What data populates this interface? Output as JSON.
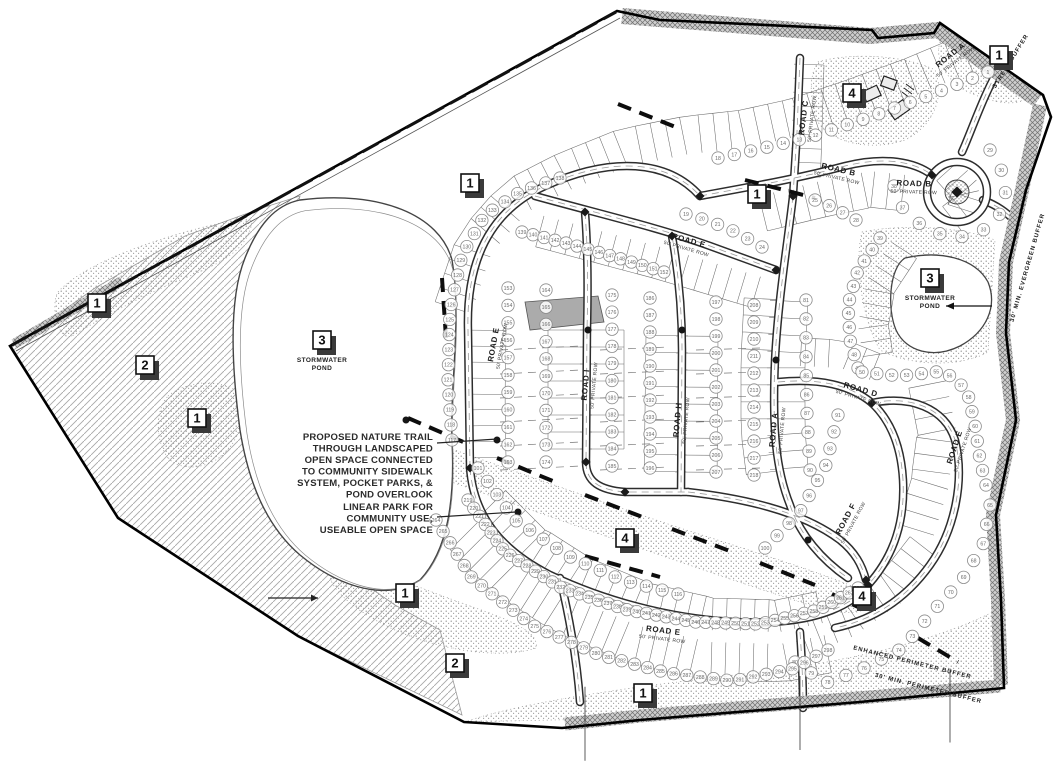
{
  "drawing": {
    "kind": "residential subdivision concept site plan",
    "colors": {
      "paper": "#ffffff",
      "ink": "#1a1a1a",
      "fabric": "#6a6a6a",
      "buffer_fill": "#c9c9c9"
    }
  },
  "callouts": [
    {
      "id": "c1",
      "label": "1",
      "x": 97,
      "y": 303
    },
    {
      "id": "c2",
      "label": "2",
      "x": 145,
      "y": 365
    },
    {
      "id": "c3",
      "label": "1",
      "x": 197,
      "y": 418
    },
    {
      "id": "c4",
      "label": "3",
      "x": 322,
      "y": 340,
      "caption_lines": [
        "STORMWATER",
        "POND"
      ]
    },
    {
      "id": "c5",
      "label": "1",
      "x": 470,
      "y": 183
    },
    {
      "id": "c6",
      "label": "1",
      "x": 757,
      "y": 194
    },
    {
      "id": "c7",
      "label": "4",
      "x": 852,
      "y": 93
    },
    {
      "id": "c8",
      "label": "1",
      "x": 999,
      "y": 55
    },
    {
      "id": "c9",
      "label": "3",
      "x": 930,
      "y": 278,
      "caption_lines": [
        "STORMWATER",
        "POND"
      ],
      "arrow": true
    },
    {
      "id": "c10",
      "label": "4",
      "x": 625,
      "y": 538
    },
    {
      "id": "c11",
      "label": "1",
      "x": 405,
      "y": 593
    },
    {
      "id": "c12",
      "label": "2",
      "x": 455,
      "y": 663
    },
    {
      "id": "c13",
      "label": "1",
      "x": 643,
      "y": 693
    },
    {
      "id": "c14",
      "label": "4",
      "x": 862,
      "y": 596
    }
  ],
  "notes": [
    {
      "id": "nature-trail",
      "lines": [
        "PROPOSED NATURE TRAIL",
        "THROUGH LANDSCAPED",
        "OPEN SPACE CONNECTED",
        "TO COMMUNITY SIDEWALK",
        "SYSTEM, POCKET PARKS, &",
        "POND OVERLOOK"
      ],
      "x": 433,
      "y": 440
    },
    {
      "id": "linear-park",
      "lines": [
        "LINEAR PARK FOR",
        "COMMUNITY USE;",
        "USEABLE OPEN SPACE"
      ],
      "x": 433,
      "y": 510
    }
  ],
  "road_labels": [
    {
      "name": "ROAD A",
      "row": "50' PRIVATE ROW",
      "x": 952,
      "y": 57,
      "rot": -38
    },
    {
      "name": "ROAD B",
      "row": "50' PRIVATE ROW",
      "x": 838,
      "y": 172,
      "rot": 13
    },
    {
      "name": "ROAD B",
      "row": "50' PRIVATE ROW",
      "x": 914,
      "y": 186,
      "rot": 2
    },
    {
      "name": "ROAD C",
      "row": "50' PRIVATE ROW",
      "x": 806,
      "y": 118,
      "rot": -83
    },
    {
      "name": "ROAD E",
      "row": "50' PRIVATE ROW",
      "x": 688,
      "y": 243,
      "rot": 16
    },
    {
      "name": "ROAD E",
      "row": "50' PRIVATE ROW",
      "x": 496,
      "y": 345,
      "rot": -80
    },
    {
      "name": "ROAD E",
      "row": "50' PRIVATE ROW",
      "x": 663,
      "y": 633,
      "rot": 7
    },
    {
      "name": "ROAD E",
      "row": "50' PRIVATE ROW",
      "x": 957,
      "y": 448,
      "rot": -72
    },
    {
      "name": "ROAD D",
      "row": "50' PRIVATE ROW",
      "x": 860,
      "y": 392,
      "rot": 16
    },
    {
      "name": "ROAD H",
      "row": "50' PRIVATE ROW",
      "x": 680,
      "y": 420,
      "rot": -85
    },
    {
      "name": "ROAD I",
      "row": "50' PRIVATE ROW",
      "x": 588,
      "y": 385,
      "rot": -85
    },
    {
      "name": "ROAD A",
      "row": "50' PRIVATE ROW",
      "x": 776,
      "y": 430,
      "rot": -85
    },
    {
      "name": "ROAD F",
      "row": "50' PRIVATE ROW",
      "x": 848,
      "y": 520,
      "rot": -62
    }
  ],
  "buffer_labels": [
    {
      "text": "STREET BUFFER",
      "x": 1012,
      "y": 62,
      "rot": -58
    },
    {
      "text": "30' MIN. EVERGREEN BUFFER",
      "x": 1029,
      "y": 268,
      "rot": -74
    },
    {
      "text": "ENHANCED PERIMETER BUFFER",
      "x": 912,
      "y": 664,
      "rot": 14
    },
    {
      "text": "30' MIN. PERIMETER BUFFER",
      "x": 928,
      "y": 690,
      "rot": 14
    }
  ],
  "ponds": [
    {
      "id": "pond-west"
    },
    {
      "id": "pond-east"
    }
  ],
  "lot_strips": [
    {
      "id": "s1",
      "start": 1,
      "end": 18
    },
    {
      "id": "s2a",
      "start": 19,
      "end": 24
    },
    {
      "id": "s2b",
      "start": 25,
      "end": 28
    },
    {
      "id": "s3",
      "start": 29,
      "end": 38
    },
    {
      "id": "s4",
      "start": 39,
      "end": 49
    },
    {
      "id": "s5",
      "start": 50,
      "end": 64
    },
    {
      "id": "s6",
      "start": 65,
      "end": 80
    },
    {
      "id": "s7",
      "start": 81,
      "end": 90
    },
    {
      "id": "s8",
      "start": 91,
      "end": 100
    },
    {
      "id": "s9",
      "start": 101,
      "end": 116
    },
    {
      "id": "s10",
      "start": 117,
      "end": 138
    },
    {
      "id": "s11",
      "start": 139,
      "end": 152
    },
    {
      "id": "col1",
      "start": 153,
      "end": 163
    },
    {
      "id": "col2",
      "start": 164,
      "end": 174
    },
    {
      "id": "col3",
      "start": 175,
      "end": 185
    },
    {
      "id": "col4",
      "start": 186,
      "end": 196
    },
    {
      "id": "col5",
      "start": 197,
      "end": 207
    },
    {
      "id": "col6",
      "start": 208,
      "end": 218
    },
    {
      "id": "s13",
      "start": 219,
      "end": 263
    },
    {
      "id": "s14",
      "start": 264,
      "end": 298
    }
  ]
}
